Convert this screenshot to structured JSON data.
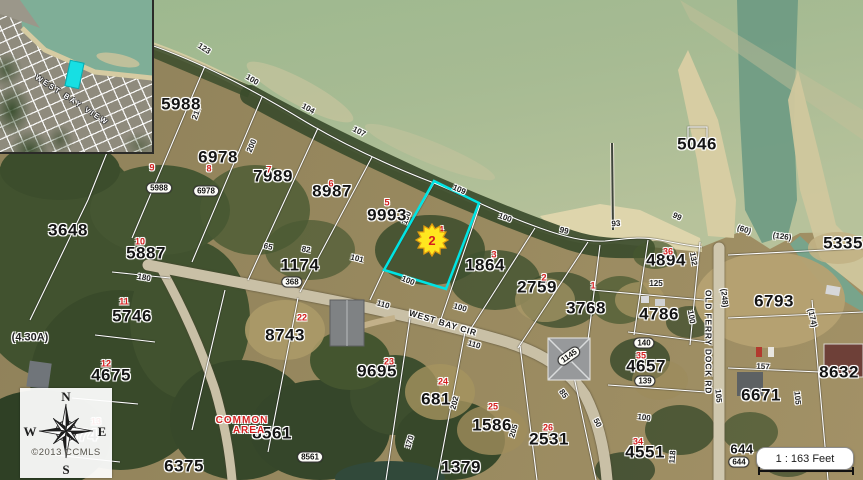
{
  "map": {
    "colors": {
      "highlight": "#00e4e4",
      "marker_fill": "#ffe71f",
      "marker_edge": "#e09b10",
      "lot_red": "#d41f1f"
    },
    "selected_marker": {
      "label": "2",
      "x": 432,
      "y": 240
    },
    "streets": [
      {
        "t": "WEST BAY CIR",
        "x": 443,
        "y": 323,
        "r": 17
      },
      {
        "t": "OLD FERRY DOCK RD",
        "x": 708,
        "y": 342,
        "r": 90
      }
    ],
    "parcel_labels": [
      {
        "t": "5988",
        "x": 181,
        "y": 104
      },
      {
        "t": "6978",
        "x": 218,
        "y": 157
      },
      {
        "t": "7989",
        "x": 273,
        "y": 176
      },
      {
        "t": "8987",
        "x": 332,
        "y": 191
      },
      {
        "t": "9993",
        "x": 387,
        "y": 215
      },
      {
        "t": "3648",
        "x": 68,
        "y": 230
      },
      {
        "t": "5887",
        "x": 146,
        "y": 253
      },
      {
        "t": "5746",
        "x": 132,
        "y": 316
      },
      {
        "t": "4675",
        "x": 111,
        "y": 375
      },
      {
        "t": "5574",
        "x": 78,
        "y": 435
      },
      {
        "t": "6375",
        "x": 184,
        "y": 466
      },
      {
        "t": "1174",
        "x": 300,
        "y": 265
      },
      {
        "t": "8743",
        "x": 285,
        "y": 335
      },
      {
        "t": "9695",
        "x": 377,
        "y": 371
      },
      {
        "t": "681",
        "x": 436,
        "y": 399
      },
      {
        "t": "1586",
        "x": 492,
        "y": 425
      },
      {
        "t": "1379",
        "x": 461,
        "y": 467
      },
      {
        "t": "2531",
        "x": 549,
        "y": 439
      },
      {
        "t": "4551",
        "x": 645,
        "y": 452
      },
      {
        "t": "1864",
        "x": 485,
        "y": 265
      },
      {
        "t": "2759",
        "x": 537,
        "y": 287
      },
      {
        "t": "3768",
        "x": 586,
        "y": 308
      },
      {
        "t": "4894",
        "x": 666,
        "y": 260
      },
      {
        "t": "4786",
        "x": 659,
        "y": 314
      },
      {
        "t": "4657",
        "x": 646,
        "y": 366
      },
      {
        "t": "6793",
        "x": 774,
        "y": 301
      },
      {
        "t": "8632",
        "x": 839,
        "y": 372
      },
      {
        "t": "6671",
        "x": 761,
        "y": 395
      },
      {
        "t": "5046",
        "x": 697,
        "y": 144
      },
      {
        "t": "5335",
        "x": 843,
        "y": 243
      },
      {
        "t": "644",
        "x": 742,
        "y": 449,
        "fs": 13
      },
      {
        "t": "8561",
        "x": 272,
        "y": 433
      }
    ],
    "lot_numbers": [
      {
        "t": "1",
        "x": 593,
        "y": 286
      },
      {
        "t": "2",
        "x": 544,
        "y": 278
      },
      {
        "t": "3",
        "x": 494,
        "y": 255
      },
      {
        "t": "4",
        "x": 441,
        "y": 230
      },
      {
        "t": "5",
        "x": 387,
        "y": 203
      },
      {
        "t": "6",
        "x": 331,
        "y": 184
      },
      {
        "t": "7",
        "x": 269,
        "y": 170
      },
      {
        "t": "8",
        "x": 209,
        "y": 169
      },
      {
        "t": "9",
        "x": 152,
        "y": 168
      },
      {
        "t": "10",
        "x": 140,
        "y": 242
      },
      {
        "t": "11",
        "x": 124,
        "y": 302
      },
      {
        "t": "12",
        "x": 106,
        "y": 364
      },
      {
        "t": "13",
        "x": 96,
        "y": 422
      },
      {
        "t": "22",
        "x": 302,
        "y": 318
      },
      {
        "t": "23",
        "x": 389,
        "y": 362
      },
      {
        "t": "24",
        "x": 443,
        "y": 382
      },
      {
        "t": "25",
        "x": 493,
        "y": 407
      },
      {
        "t": "26",
        "x": 548,
        "y": 428
      },
      {
        "t": "34",
        "x": 638,
        "y": 442
      },
      {
        "t": "35",
        "x": 641,
        "y": 356
      },
      {
        "t": "36",
        "x": 668,
        "y": 252
      }
    ],
    "dimension_labels": [
      {
        "t": "123",
        "x": 204,
        "y": 49,
        "r": 33
      },
      {
        "t": "100",
        "x": 252,
        "y": 80,
        "r": 31
      },
      {
        "t": "104",
        "x": 308,
        "y": 109,
        "r": 29
      },
      {
        "t": "107",
        "x": 359,
        "y": 132,
        "r": 27
      },
      {
        "t": "109",
        "x": 459,
        "y": 190,
        "r": 24
      },
      {
        "t": "100",
        "x": 505,
        "y": 218,
        "r": 20
      },
      {
        "t": "99",
        "x": 564,
        "y": 231,
        "r": 12
      },
      {
        "t": "93",
        "x": 616,
        "y": 224,
        "r": -5
      },
      {
        "t": "217",
        "x": 197,
        "y": 113,
        "r": -70
      },
      {
        "t": "200",
        "x": 252,
        "y": 146,
        "r": -67
      },
      {
        "t": "100",
        "x": 407,
        "y": 218,
        "r": -68
      },
      {
        "t": "100",
        "x": 408,
        "y": 281,
        "r": 22
      },
      {
        "t": "65",
        "x": 268,
        "y": 247,
        "r": 12
      },
      {
        "t": "82",
        "x": 306,
        "y": 250,
        "r": 10
      },
      {
        "t": "101",
        "x": 357,
        "y": 259,
        "r": 14
      },
      {
        "t": "110",
        "x": 383,
        "y": 305,
        "r": 16
      },
      {
        "t": "100",
        "x": 460,
        "y": 308,
        "r": 16
      },
      {
        "t": "110",
        "x": 474,
        "y": 345,
        "r": 16
      },
      {
        "t": "202",
        "x": 455,
        "y": 403,
        "r": -75
      },
      {
        "t": "205",
        "x": 514,
        "y": 431,
        "r": -73
      },
      {
        "t": "170",
        "x": 410,
        "y": 442,
        "r": -73
      },
      {
        "t": "85",
        "x": 563,
        "y": 394,
        "r": 55
      },
      {
        "t": "50",
        "x": 597,
        "y": 423,
        "r": 62
      },
      {
        "t": "100",
        "x": 644,
        "y": 418,
        "r": 8
      },
      {
        "t": "118",
        "x": 673,
        "y": 457,
        "r": -85
      },
      {
        "t": "180",
        "x": 144,
        "y": 278,
        "r": 10
      },
      {
        "t": "(4.30A)",
        "x": 30,
        "y": 338,
        "r": 0,
        "fs": 11
      },
      {
        "t": "125",
        "x": 656,
        "y": 284,
        "r": 0
      },
      {
        "t": "132",
        "x": 693,
        "y": 259,
        "r": 80
      },
      {
        "t": "100",
        "x": 691,
        "y": 317,
        "r": 80
      },
      {
        "t": "(248)",
        "x": 724,
        "y": 298,
        "r": 85
      },
      {
        "t": "105",
        "x": 718,
        "y": 396,
        "r": 85
      },
      {
        "t": "157",
        "x": 763,
        "y": 367,
        "r": 3
      },
      {
        "t": "(174)",
        "x": 812,
        "y": 318,
        "r": 78
      },
      {
        "t": "105",
        "x": 797,
        "y": 398,
        "r": 85
      },
      {
        "t": "(60)",
        "x": 744,
        "y": 230,
        "r": 18
      },
      {
        "t": "(126)",
        "x": 782,
        "y": 237,
        "r": 8
      },
      {
        "t": "99",
        "x": 677,
        "y": 217,
        "r": 25
      }
    ],
    "address_bubbles": [
      {
        "t": "5988",
        "x": 159,
        "y": 188
      },
      {
        "t": "6978",
        "x": 206,
        "y": 191
      },
      {
        "t": "368",
        "x": 292,
        "y": 282
      },
      {
        "t": "8561",
        "x": 310,
        "y": 457
      },
      {
        "t": "1145",
        "x": 569,
        "y": 356,
        "r": -35
      },
      {
        "t": "644",
        "x": 739,
        "y": 462
      },
      {
        "t": "140",
        "x": 644,
        "y": 343
      },
      {
        "t": "139",
        "x": 645,
        "y": 381
      }
    ],
    "red_area_labels": [
      {
        "t": "COMMON",
        "x": 242,
        "y": 421
      },
      {
        "t": "AREA",
        "x": 249,
        "y": 431
      }
    ]
  },
  "inset": {
    "street_text": "WEST BAY VIEW"
  },
  "compass": {
    "north": "N",
    "south": "S",
    "east": "E",
    "west": "W"
  },
  "attribution": "©2013 CCMLS",
  "scalebar": {
    "label": "1 : 163 Feet"
  }
}
